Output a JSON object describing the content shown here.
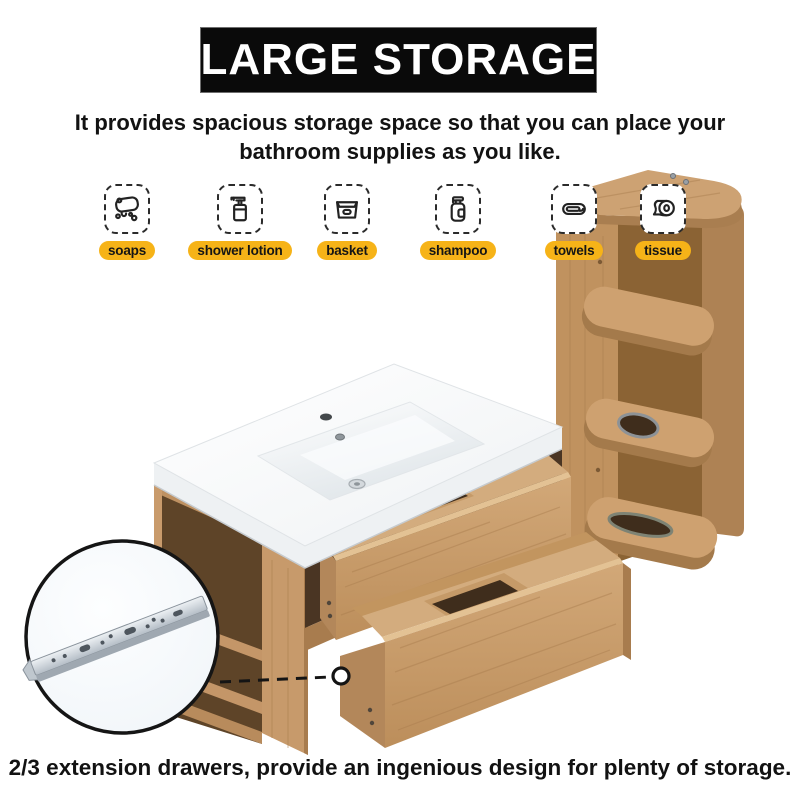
{
  "banner": {
    "title": "LARGE STORAGE"
  },
  "subtitle": {
    "line1": "It provides spacious storage space so that you can place your",
    "line2": "bathroom supplies as you like."
  },
  "features": [
    {
      "id": "soaps",
      "label": "soaps",
      "icon": "soap-icon"
    },
    {
      "id": "shower-lotion",
      "label": "shower lotion",
      "icon": "lotion-bottle-icon"
    },
    {
      "id": "basket",
      "label": "basket",
      "icon": "basket-icon"
    },
    {
      "id": "shampoo",
      "label": "shampoo",
      "icon": "shampoo-bottle-icon"
    },
    {
      "id": "towels",
      "label": "towels",
      "icon": "towel-icon"
    },
    {
      "id": "tissue",
      "label": "tissue",
      "icon": "toilet-paper-icon"
    }
  ],
  "caption": "2/3 extension drawers, provide an ingenious design for plenty of storage.",
  "colors": {
    "accent_yellow": "#F6B318",
    "banner_bg": "#0A0A0A",
    "wood_light": "#CEA170",
    "wood_medium": "#C0925F",
    "wood_dark": "#A87C4E",
    "interior_shadow": "#4A3523",
    "ceramic_white": "#FAFBFC"
  },
  "scene": {
    "inset_icon": "drawer-slide-rail"
  }
}
